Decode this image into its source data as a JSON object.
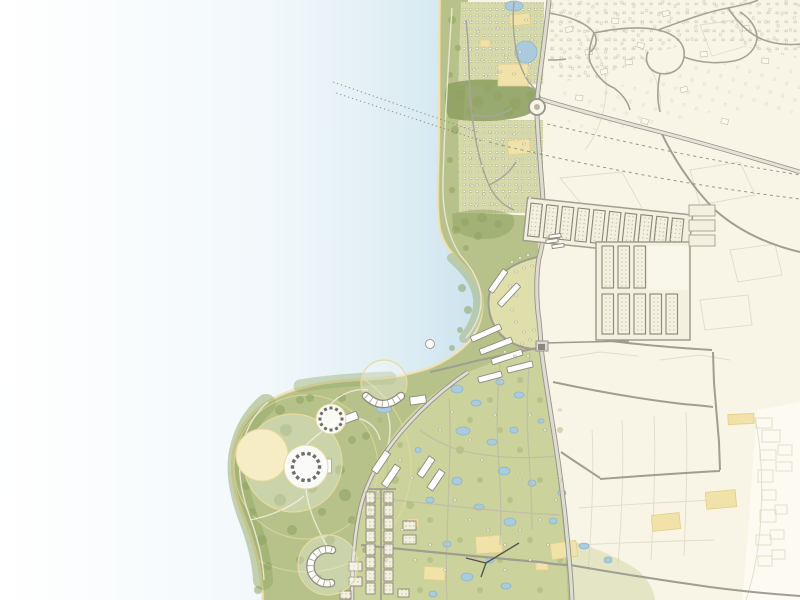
{
  "map": {
    "kind": "illustrative-coastal-masterplan",
    "colors": {
      "paper": "#F8F5E6",
      "paper_pale": "#FCFAF1",
      "water_near": "#CBE2EE",
      "water_mid": "#E6F2F7",
      "water_far": "#FFFFFF",
      "sand": "#EDE2B8",
      "sand_line": "#D8C78E",
      "green": "#B6C28A",
      "green_light": "#CBD29C",
      "green_pale": "#D6DAA8",
      "green_dark": "#8EA263",
      "green_mid": "#9FAF74",
      "cream_band": "#DFDFAC",
      "road_casing": "#97948A",
      "road_fill": "#DEDBD0",
      "road_minor": "#A5A296",
      "lane_light": "#ECE8D2",
      "parcel": "#DFD9C4",
      "parcel_dark": "#CCC5AD",
      "building_stroke": "#B3AC96",
      "grid_outline": "#8A8778",
      "grid_fill": "#F4F0DF",
      "grid_dot": "#ACA590",
      "dark_building": "#6F6E66",
      "circle_stroke": "#E7DA9E",
      "cream_fill": "#F6EDC6",
      "pond": "#A9CBDD",
      "pond_stroke": "#8FB6CC",
      "plot": "#F0E2A8",
      "plot_stroke": "#E2CF8C",
      "dash_line": "#8F8C80",
      "ferry_dash": "#85837A",
      "power_line": "#55544C",
      "white": "#FFFFFF"
    },
    "ferry_dashes": [
      [
        333,
        82,
        480,
        133
      ],
      [
        336,
        93,
        482,
        141
      ]
    ],
    "trees": [
      [
        452,
        20,
        4,
        0
      ],
      [
        458,
        48,
        3,
        0
      ],
      [
        450,
        75,
        3,
        0
      ],
      [
        455,
        130,
        4,
        0
      ],
      [
        450,
        160,
        3,
        0
      ],
      [
        452,
        190,
        3,
        0
      ],
      [
        456,
        230,
        4,
        0
      ],
      [
        466,
        248,
        3,
        0
      ],
      [
        460,
        95,
        5,
        0
      ],
      [
        478,
        102,
        6,
        0
      ],
      [
        498,
        96,
        5,
        0
      ],
      [
        515,
        104,
        6,
        0
      ],
      [
        530,
        95,
        4,
        0
      ],
      [
        470,
        112,
        4,
        0
      ],
      [
        508,
        112,
        5,
        0
      ],
      [
        488,
        88,
        4,
        0
      ],
      [
        465,
        222,
        4,
        0
      ],
      [
        482,
        218,
        5,
        0
      ],
      [
        498,
        224,
        4,
        0
      ],
      [
        478,
        236,
        4,
        0
      ],
      [
        462,
        288,
        4,
        0
      ],
      [
        468,
        310,
        4,
        0
      ],
      [
        460,
        330,
        3,
        0
      ],
      [
        452,
        348,
        3,
        0
      ],
      [
        280,
        410,
        5,
        0
      ],
      [
        300,
        400,
        4,
        0
      ],
      [
        262,
        432,
        4,
        0
      ],
      [
        250,
        458,
        5,
        0
      ],
      [
        246,
        486,
        4,
        0
      ],
      [
        252,
        512,
        4,
        0
      ],
      [
        262,
        540,
        5,
        0
      ],
      [
        268,
        566,
        4,
        0
      ],
      [
        286,
        430,
        6,
        0
      ],
      [
        272,
        470,
        5,
        0
      ],
      [
        280,
        500,
        6,
        0
      ],
      [
        292,
        530,
        5,
        0
      ],
      [
        300,
        560,
        4,
        0
      ],
      [
        312,
        488,
        5,
        0
      ],
      [
        322,
        512,
        4,
        0
      ],
      [
        340,
        470,
        5,
        0
      ],
      [
        352,
        440,
        4,
        0
      ],
      [
        345,
        495,
        6,
        0
      ],
      [
        330,
        540,
        5,
        0
      ],
      [
        318,
        578,
        4,
        0
      ],
      [
        352,
        520,
        4,
        0
      ],
      [
        365,
        550,
        3,
        0
      ],
      [
        258,
        590,
        4,
        0
      ],
      [
        342,
        398,
        4,
        0
      ],
      [
        366,
        436,
        4,
        0
      ],
      [
        310,
        398,
        4,
        0
      ],
      [
        380,
        420,
        3,
        1
      ],
      [
        400,
        445,
        3,
        1
      ],
      [
        420,
        470,
        3,
        1
      ],
      [
        395,
        480,
        4,
        1
      ],
      [
        410,
        505,
        4,
        1
      ],
      [
        390,
        530,
        3,
        1
      ],
      [
        430,
        520,
        3,
        1
      ],
      [
        470,
        420,
        3,
        1
      ],
      [
        490,
        400,
        3,
        1
      ],
      [
        520,
        380,
        3,
        1
      ],
      [
        460,
        450,
        4,
        1
      ],
      [
        500,
        430,
        3,
        1
      ],
      [
        540,
        400,
        3,
        1
      ],
      [
        520,
        450,
        3,
        1
      ],
      [
        480,
        480,
        3,
        1
      ],
      [
        510,
        500,
        3,
        1
      ],
      [
        540,
        480,
        3,
        1
      ],
      [
        560,
        430,
        3,
        1
      ],
      [
        430,
        560,
        3,
        1
      ],
      [
        460,
        540,
        3,
        1
      ],
      [
        500,
        560,
        3,
        1
      ],
      [
        530,
        540,
        3,
        1
      ],
      [
        560,
        560,
        3,
        1
      ],
      [
        420,
        590,
        3,
        1
      ],
      [
        480,
        590,
        3,
        1
      ],
      [
        540,
        590,
        3,
        1
      ]
    ],
    "ponds": [
      [
        514,
        6,
        9,
        5
      ],
      [
        526,
        52,
        11,
        11
      ],
      [
        384,
        409,
        8,
        3.5
      ],
      [
        457,
        389,
        6,
        4
      ],
      [
        476,
        403,
        5,
        3
      ],
      [
        500,
        382,
        4,
        3
      ],
      [
        519,
        395,
        5,
        3
      ],
      [
        463,
        431,
        7,
        4
      ],
      [
        492,
        442,
        5,
        3
      ],
      [
        514,
        430,
        4,
        3
      ],
      [
        457,
        481,
        5,
        4
      ],
      [
        504,
        471,
        6,
        4
      ],
      [
        532,
        483,
        4,
        3
      ],
      [
        479,
        507,
        5,
        3
      ],
      [
        510,
        522,
        6,
        4
      ],
      [
        447,
        544,
        4,
        3
      ],
      [
        467,
        577,
        6,
        4
      ],
      [
        506,
        586,
        5,
        3
      ],
      [
        433,
        594,
        4,
        3
      ],
      [
        553,
        521,
        4,
        3
      ],
      [
        584,
        546,
        5,
        3
      ],
      [
        608,
        560,
        4,
        3
      ],
      [
        541,
        421,
        3,
        2.2
      ],
      [
        562,
        493,
        4,
        3
      ],
      [
        490,
        560,
        4,
        3
      ],
      [
        430,
        500,
        4,
        3
      ],
      [
        418,
        450,
        3,
        2.5
      ]
    ],
    "plots": [
      [
        498,
        64,
        30,
        22,
        0
      ],
      [
        510,
        14,
        20,
        11,
        -6
      ],
      [
        480,
        40,
        10,
        7,
        0
      ],
      [
        508,
        140,
        22,
        14,
        -4
      ],
      [
        476,
        536,
        26,
        17,
        -4
      ],
      [
        424,
        567,
        21,
        13,
        3
      ],
      [
        408,
        519,
        10,
        8,
        0
      ],
      [
        551,
        542,
        26,
        16,
        -8
      ],
      [
        536,
        562,
        12,
        8,
        0
      ],
      [
        652,
        514,
        28,
        16,
        -6
      ],
      [
        706,
        491,
        30,
        17,
        -5
      ],
      [
        728,
        414,
        26,
        10,
        -3
      ]
    ],
    "terraces": [
      [
        498,
        281,
        26,
        6,
        -55
      ],
      [
        509,
        295,
        28,
        6,
        -47
      ],
      [
        486,
        333,
        32,
        6,
        -24
      ],
      [
        496,
        346,
        34,
        6,
        -21
      ],
      [
        507,
        357,
        32,
        6,
        -18
      ],
      [
        520,
        367,
        26,
        6,
        -14
      ],
      [
        490,
        377,
        24,
        6,
        -15
      ]
    ],
    "bars": [
      [
        381,
        462,
        24,
        7,
        -56
      ],
      [
        391,
        476,
        24,
        7,
        -56
      ],
      [
        426,
        467,
        22,
        7,
        -56
      ],
      [
        436,
        480,
        22,
        7,
        -56
      ],
      [
        349,
        418,
        18,
        8,
        -20
      ],
      [
        418,
        400,
        16,
        8,
        -8
      ],
      [
        327,
        466,
        9,
        14,
        0
      ],
      [
        552,
        241,
        12,
        3.5,
        -8
      ],
      [
        555,
        236,
        12,
        3.5,
        -8
      ],
      [
        558,
        246,
        12,
        3.5,
        -8
      ]
    ],
    "specks": [
      [
        512,
        262
      ],
      [
        520,
        258
      ],
      [
        528,
        255
      ],
      [
        516,
        272
      ],
      [
        524,
        268
      ],
      [
        532,
        266
      ],
      [
        510,
        286
      ],
      [
        516,
        296
      ],
      [
        512,
        310
      ],
      [
        516,
        322
      ],
      [
        524,
        332
      ],
      [
        530,
        340
      ],
      [
        522,
        344
      ],
      [
        534,
        330
      ],
      [
        505,
        352
      ],
      [
        515,
        356
      ],
      [
        528,
        356
      ],
      [
        370,
        510
      ],
      [
        378,
        492
      ],
      [
        400,
        460
      ],
      [
        412,
        478
      ],
      [
        440,
        430
      ],
      [
        452,
        412
      ],
      [
        470,
        440
      ],
      [
        482,
        460
      ],
      [
        455,
        500
      ],
      [
        470,
        520
      ],
      [
        488,
        530
      ],
      [
        505,
        545
      ],
      [
        520,
        530
      ],
      [
        540,
        520
      ],
      [
        430,
        545
      ],
      [
        415,
        560
      ],
      [
        445,
        570
      ],
      [
        475,
        560
      ],
      [
        505,
        570
      ],
      [
        530,
        560
      ],
      [
        402,
        530
      ],
      [
        386,
        560
      ],
      [
        556,
        500
      ],
      [
        548,
        545
      ],
      [
        560,
        480
      ],
      [
        545,
        430
      ],
      [
        560,
        410
      ],
      [
        530,
        415
      ],
      [
        495,
        415
      ],
      [
        520,
        480
      ],
      [
        470,
        20
      ],
      [
        478,
        32
      ],
      [
        488,
        18
      ],
      [
        498,
        28
      ],
      [
        508,
        14
      ],
      [
        518,
        30
      ],
      [
        526,
        20
      ],
      [
        532,
        40
      ],
      [
        470,
        50
      ],
      [
        482,
        60
      ],
      [
        494,
        50
      ],
      [
        506,
        58
      ],
      [
        520,
        52
      ],
      [
        530,
        64
      ],
      [
        474,
        70
      ],
      [
        486,
        76
      ],
      [
        500,
        72
      ],
      [
        514,
        74
      ],
      [
        526,
        76
      ],
      [
        468,
        130
      ],
      [
        478,
        140
      ],
      [
        490,
        132
      ],
      [
        502,
        142
      ],
      [
        514,
        134
      ],
      [
        524,
        144
      ],
      [
        532,
        152
      ],
      [
        470,
        158
      ],
      [
        482,
        166
      ],
      [
        494,
        158
      ],
      [
        506,
        168
      ],
      [
        518,
        160
      ],
      [
        528,
        172
      ],
      [
        472,
        186
      ],
      [
        484,
        194
      ],
      [
        496,
        186
      ],
      [
        508,
        196
      ],
      [
        520,
        188
      ],
      [
        530,
        198
      ],
      [
        476,
        206
      ],
      [
        492,
        204
      ],
      [
        510,
        206
      ]
    ],
    "rings": [
      {
        "cx": 306,
        "cy": 467,
        "r": 13.5,
        "n": 14,
        "s": 3.4
      },
      {
        "cx": 331,
        "cy": 419,
        "r": 11,
        "n": 12,
        "s": 3
      }
    ],
    "circles": [
      {
        "kind": "ring_ghost",
        "cx": 306,
        "cy": 467,
        "r": 72
      },
      {
        "kind": "ring_ghost",
        "cx": 306,
        "cy": 467,
        "r": 105
      },
      {
        "kind": "ghost",
        "cx": 384,
        "cy": 383,
        "r": 23
      },
      {
        "kind": "ghost",
        "cx": 293,
        "cy": 463,
        "r": 49
      },
      {
        "kind": "ghost",
        "cx": 328,
        "cy": 565,
        "r": 30
      },
      {
        "kind": "cream",
        "cx": 262,
        "cy": 455,
        "r": 26
      },
      {
        "kind": "white",
        "cx": 306,
        "cy": 467,
        "r": 22
      },
      {
        "kind": "white",
        "cx": 331,
        "cy": 419,
        "r": 15
      }
    ],
    "grid_top_row": {
      "x0": 531,
      "y": 203,
      "w": 11.5,
      "h": 33,
      "dx": 15.8,
      "n": 10,
      "rot": 6
    },
    "grid_lower": {
      "w": 11.5,
      "band1": {
        "x0": 602,
        "y": 246,
        "h": 42,
        "dx": 16,
        "n": 3
      },
      "band2": {
        "x0": 602,
        "y": 294,
        "h": 40,
        "dx": 16,
        "n": 5
      }
    },
    "grid_ext_blocks": [
      [
        689,
        205,
        26,
        11
      ],
      [
        689,
        220,
        26,
        11
      ],
      [
        689,
        235,
        26,
        11
      ]
    ],
    "ladder": {
      "x_left": 366,
      "x_right": 384,
      "y0": 492,
      "dy": 13,
      "n": 8,
      "w": 9,
      "h": 11
    },
    "ladder_extra": [
      [
        349,
        562,
        13,
        9
      ],
      [
        349,
        577,
        13,
        9
      ],
      [
        403,
        521,
        13,
        9
      ],
      [
        403,
        535,
        13,
        9
      ],
      [
        340,
        591,
        11,
        8
      ],
      [
        398,
        589,
        11,
        8
      ]
    ],
    "oldtown_buildings": [
      [
        565,
        28
      ],
      [
        585,
        50
      ],
      [
        612,
        18
      ],
      [
        638,
        42
      ],
      [
        662,
        12
      ],
      [
        700,
        52
      ],
      [
        576,
        95
      ],
      [
        642,
        118
      ],
      [
        680,
        88
      ],
      [
        742,
        26
      ],
      [
        762,
        58
      ],
      [
        722,
        118
      ],
      [
        600,
        70
      ],
      [
        625,
        60
      ]
    ],
    "pale_parcels": [
      [
        756,
        418,
        16,
        10
      ],
      [
        762,
        430,
        18,
        12
      ],
      [
        760,
        450,
        16,
        10
      ],
      [
        778,
        445,
        14,
        10
      ],
      [
        758,
        470,
        15,
        12
      ],
      [
        776,
        462,
        16,
        9
      ],
      [
        762,
        490,
        14,
        10
      ],
      [
        760,
        510,
        16,
        12
      ],
      [
        775,
        505,
        12,
        9
      ],
      [
        756,
        535,
        15,
        10
      ],
      [
        770,
        530,
        14,
        9
      ],
      [
        758,
        556,
        14,
        10
      ],
      [
        772,
        550,
        13,
        9
      ]
    ]
  }
}
